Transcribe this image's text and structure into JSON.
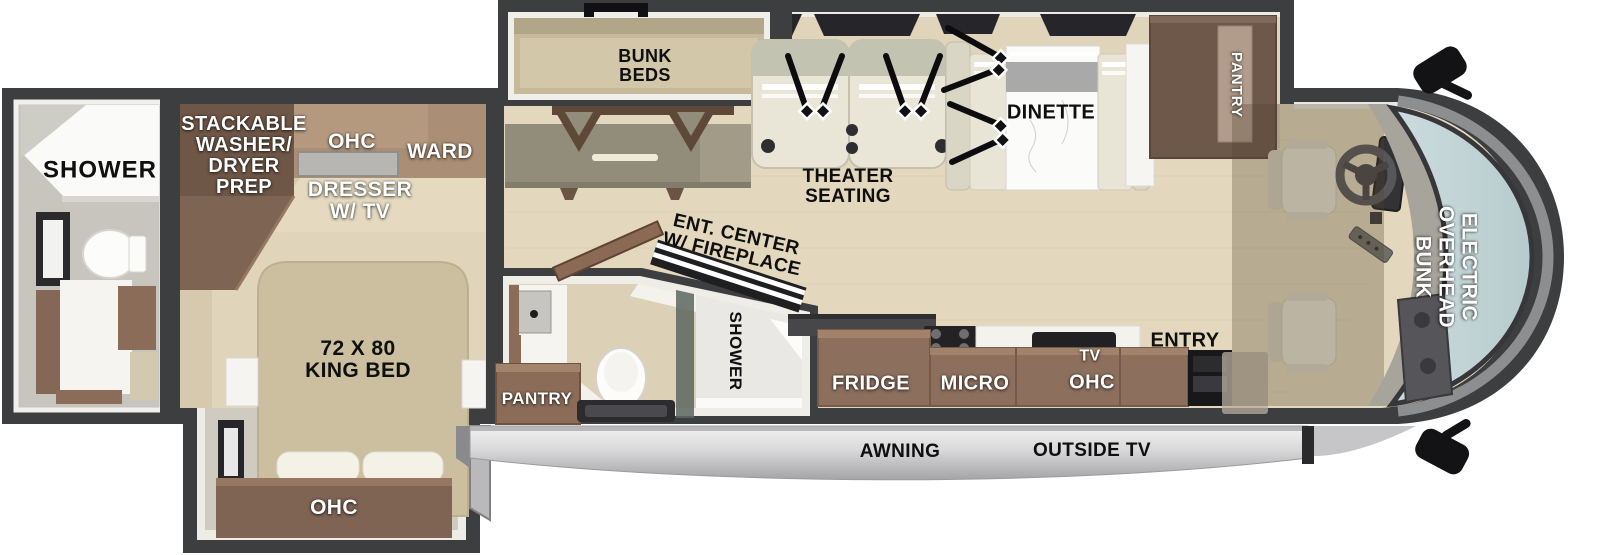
{
  "labels": {
    "rear_bath": {
      "shower": "SHOWER"
    },
    "bedroom": {
      "washer_dryer_prep": "STACKABLE\nWASHER/\nDRYER\nPREP",
      "ohc": "OHC",
      "ward": "WARD",
      "dresser_tv": "DRESSER\nW/ TV",
      "king_bed": "72 X 80\nKING BED",
      "foot_ohc": "OHC"
    },
    "mid_bath": {
      "pantry": "PANTRY",
      "shower": "SHOWER"
    },
    "living": {
      "bunk_beds": "BUNK\nBEDS",
      "theater_seating": "THEATER\nSEATING",
      "dinette": "DINETTE",
      "pantry": "PANTRY",
      "ent_center": "ENT. CENTER\nW/ FIREPLACE",
      "entry": "ENTRY"
    },
    "kitchen": {
      "fridge": "FRIDGE",
      "micro": "MICRO",
      "tv": "TV",
      "ohc": "OHC"
    },
    "cab": {
      "overhead_bunk": "ELECTRIC\nOVERHEAD\nBUNK"
    },
    "exterior": {
      "awning": "AWNING",
      "outside_tv": "OUTSIDE TV"
    }
  },
  "colors": {
    "wall": "#3d3e40",
    "floor_wood": "#e3d8bd",
    "cabinet_brown": "#8d6f5d",
    "cabinet_dark_brown": "#6e5849",
    "upholstery": "#e9e6d7",
    "bed": "#cbbfa0",
    "windshield_glass": "#c2d4d6",
    "awning_silver": "#d9d9da",
    "label_dark": "#0f0f10",
    "label_light": "#ffffff"
  }
}
